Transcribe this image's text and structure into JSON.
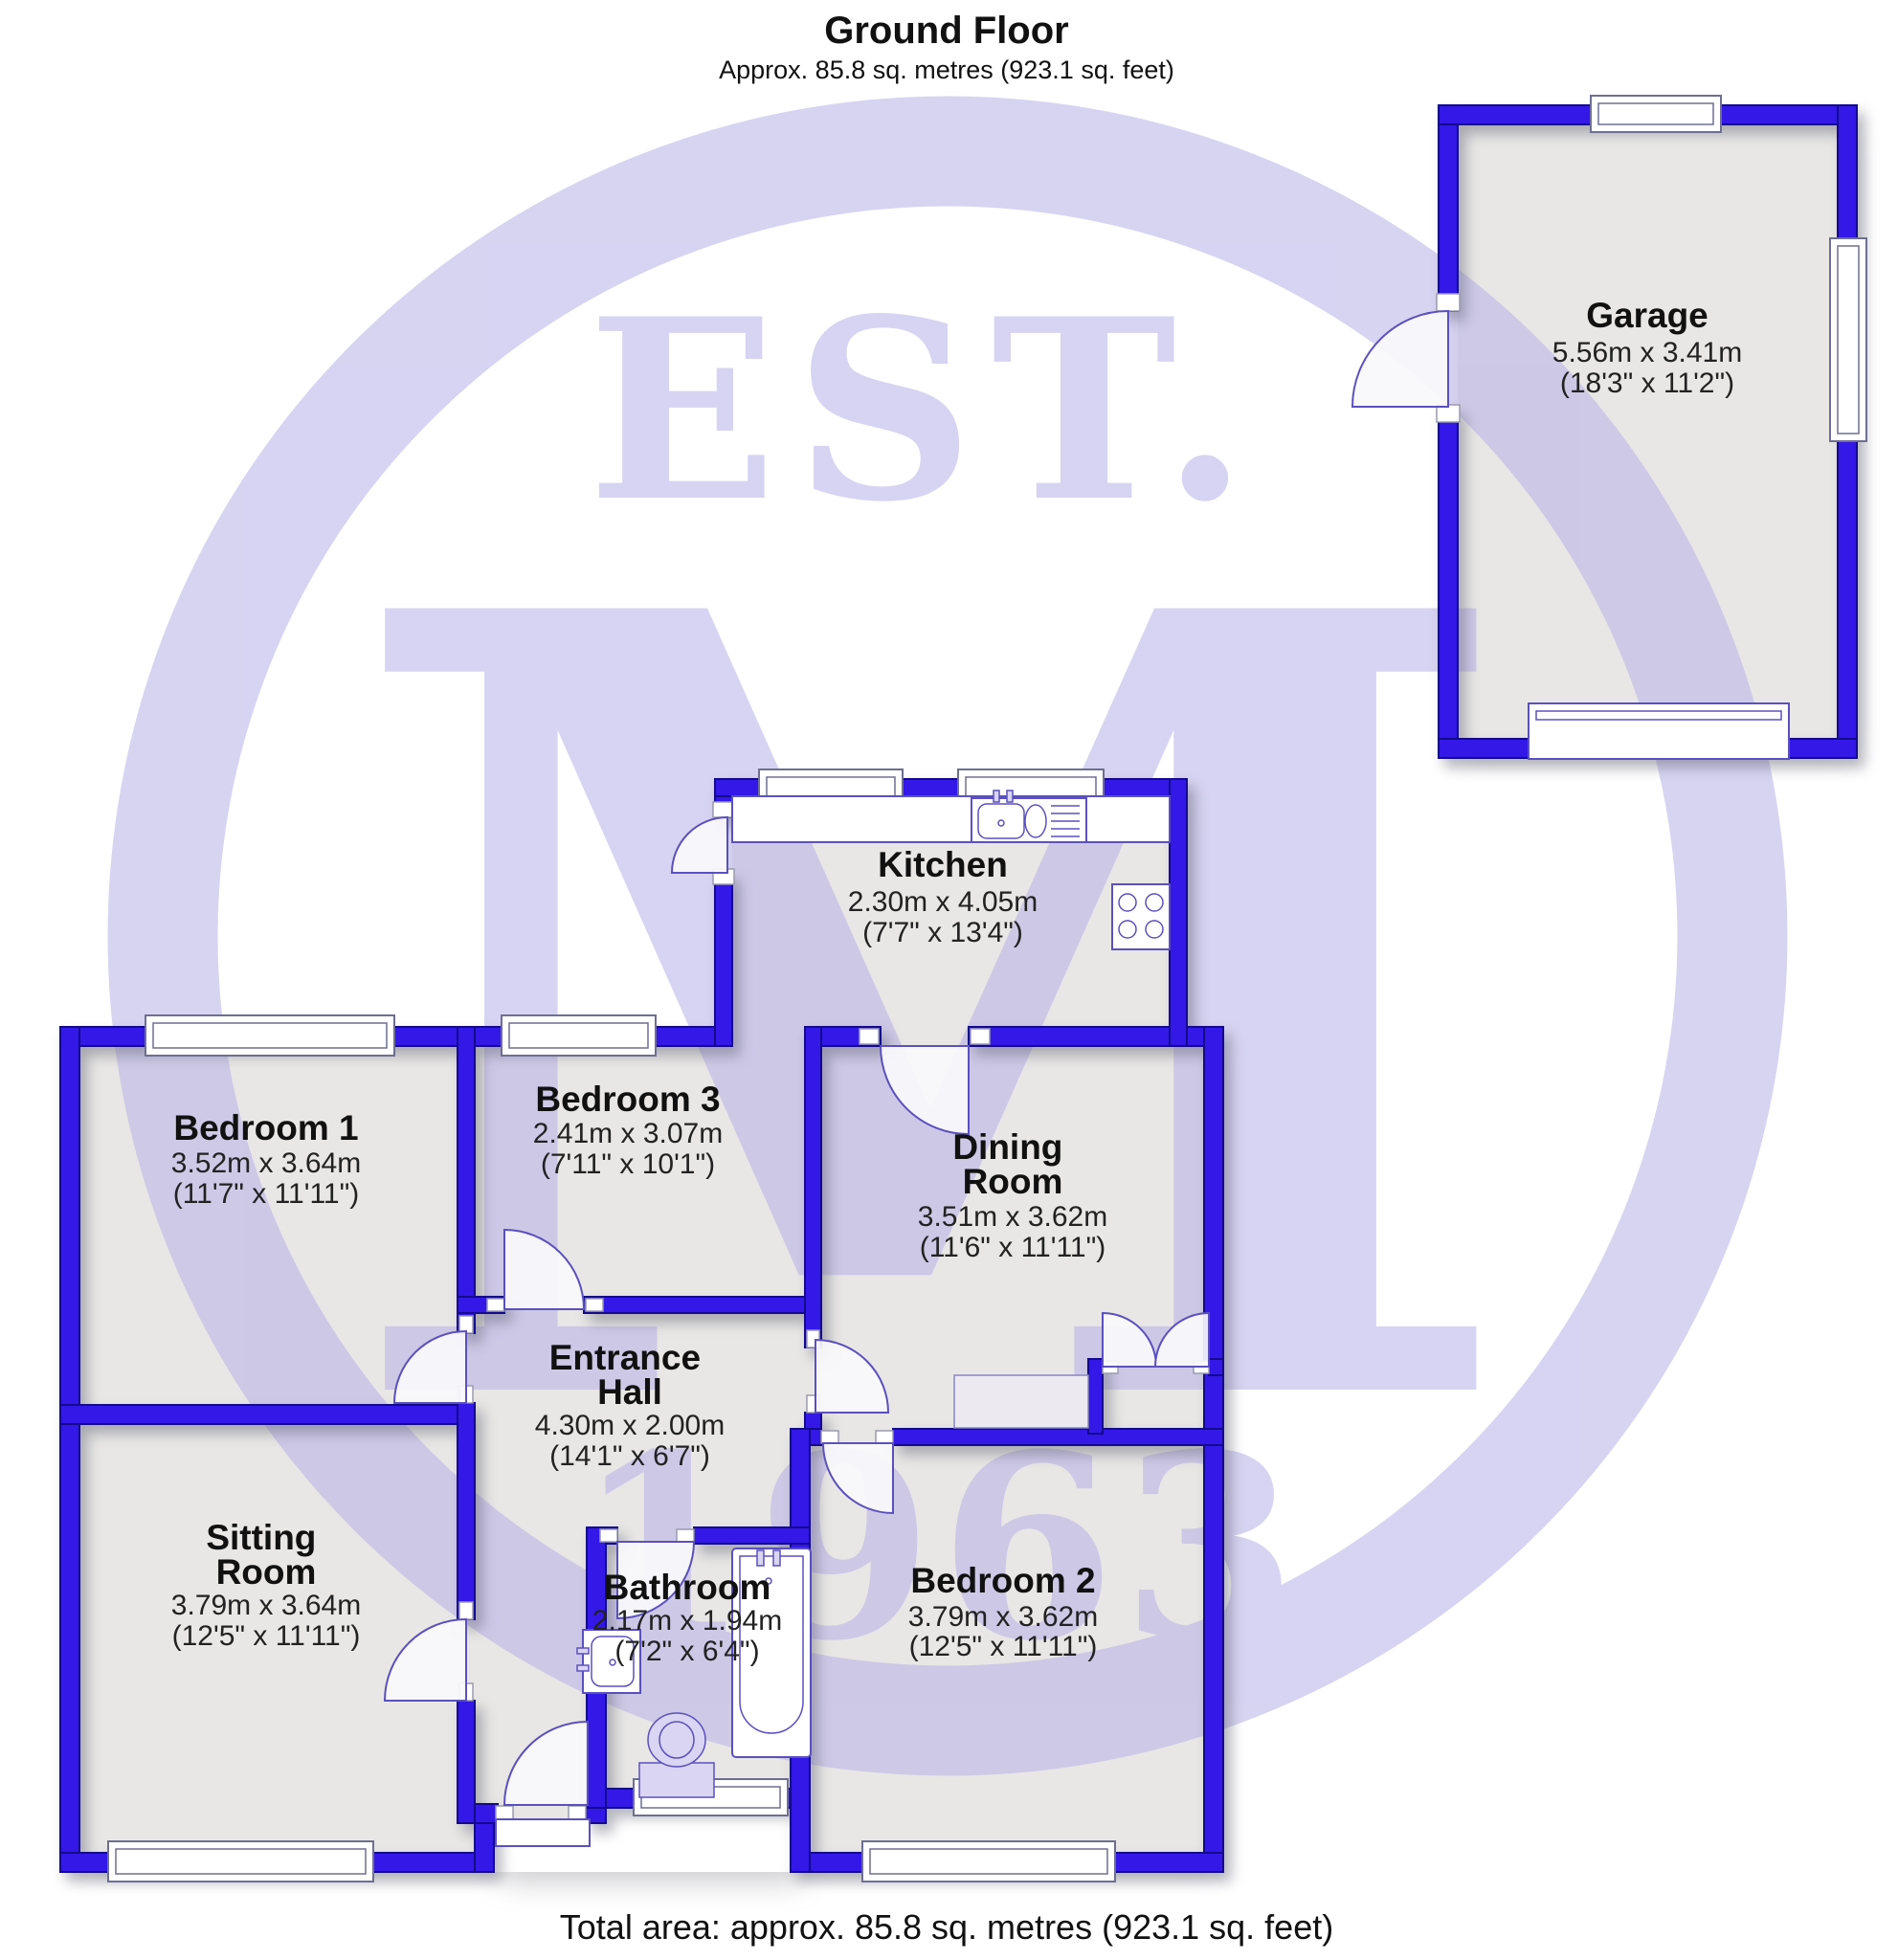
{
  "header": {
    "title": "Ground Floor",
    "subtitle": "Approx. 85.8 sq. metres (923.1 sq. feet)"
  },
  "footer": {
    "total": "Total area: approx. 85.8 sq. metres (923.1 sq. feet)"
  },
  "watermark": {
    "est": "EST.",
    "monogram": "M",
    "year": "1963",
    "color": "#b7b0e8"
  },
  "palette": {
    "wall_blue": "#3318e8",
    "wall_edge": "#140a8c",
    "floor_grey": "#e8e7e5",
    "fixture_stroke": "#5b50bd"
  },
  "rooms": {
    "garage": {
      "name": "Garage",
      "metric": "5.56m x 3.41m",
      "imperial": "(18'3\" x 11'2\")"
    },
    "kitchen": {
      "name": "Kitchen",
      "metric": "2.30m x 4.05m",
      "imperial": "(7'7\" x 13'4\")"
    },
    "bedroom1": {
      "name": "Bedroom 1",
      "metric": "3.52m x 3.64m",
      "imperial": "(11'7\" x 11'11\")"
    },
    "bedroom3": {
      "name": "Bedroom 3",
      "metric": "2.41m x 3.07m",
      "imperial": "(7'11\" x 10'1\")"
    },
    "dining": {
      "name_line1": "Dining",
      "name_line2": "Room",
      "metric": "3.51m x 3.62m",
      "imperial": "(11'6\" x 11'11\")"
    },
    "hall": {
      "name_line1": "Entrance",
      "name_line2": "Hall",
      "metric": "4.30m x 2.00m",
      "imperial": "(14'1\" x 6'7\")"
    },
    "sitting": {
      "name_line1": "Sitting",
      "name_line2": "Room",
      "metric": "3.79m x 3.64m",
      "imperial": "(12'5\" x 11'11\")"
    },
    "bathroom": {
      "name": "Bathroom",
      "metric": "2.17m x 1.94m",
      "imperial": "(7'2\" x 6'4\")"
    },
    "bedroom2": {
      "name": "Bedroom 2",
      "metric": "3.79m x 3.62m",
      "imperial": "(12'5\" x 11'11\")"
    }
  }
}
